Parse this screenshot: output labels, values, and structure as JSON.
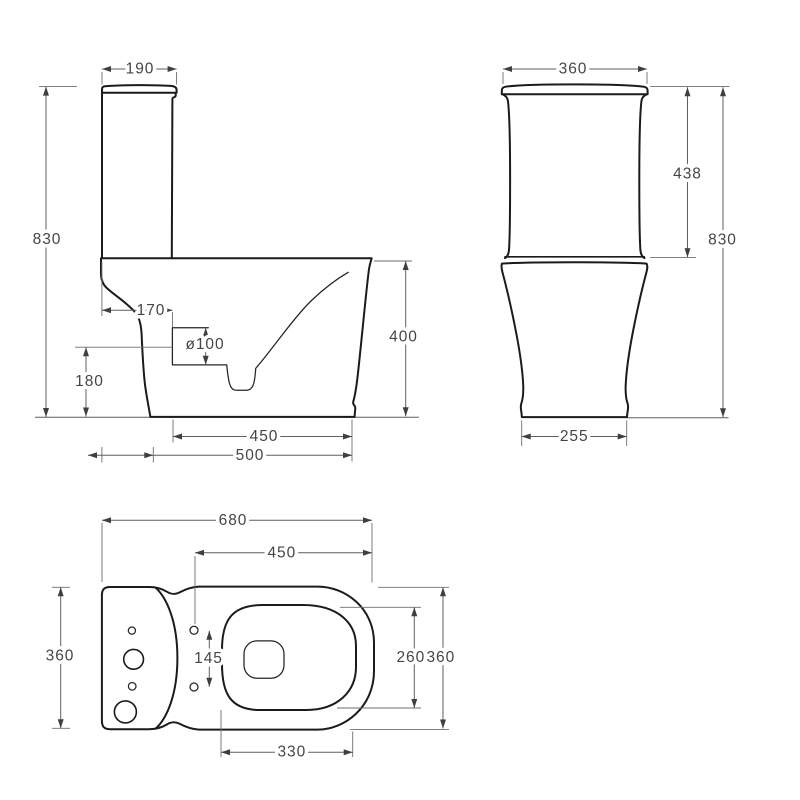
{
  "drawing": {
    "type": "technical-dimension-drawing",
    "subject": "close-coupled two-piece toilet shown in side, front and top orthographic views with millimetre dimensions",
    "colors": {
      "background": "#ffffff",
      "object_line": "#1b1b1b",
      "dimension_line": "#5f5f5f",
      "text": "#454545"
    },
    "views": {
      "side": {
        "label": "side view",
        "dims": {
          "tank_depth_top": "190",
          "overall_height": "830",
          "rim_to_trap": "170",
          "trap_diameter": "ø100",
          "trap_center_height": "180",
          "bowl_height": "400",
          "bowl_depth": "450",
          "overall_depth": "500"
        }
      },
      "front": {
        "label": "front view",
        "dims": {
          "tank_width": "360",
          "tank_height": "438",
          "overall_height": "830",
          "base_width": "255"
        }
      },
      "top": {
        "label": "top view",
        "dims": {
          "overall_length": "680",
          "bowl_length": "450",
          "tank_width": "360",
          "fixing_hole_spacing": "145",
          "seat_inner_width": "260",
          "overall_width": "360",
          "seat_length": "330"
        }
      }
    }
  }
}
